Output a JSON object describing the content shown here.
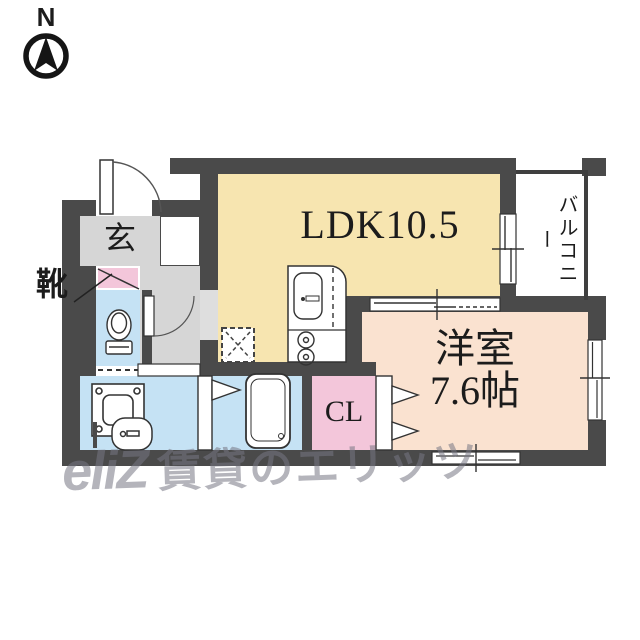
{
  "compass": {
    "north_label": "N"
  },
  "rooms": {
    "ldk": {
      "label": "LDK10.5"
    },
    "western_room": {
      "name": "洋室",
      "size": "7.6帖"
    },
    "closet": {
      "label": "CL"
    },
    "entrance": {
      "label": "玄"
    },
    "shoe_cabinet": {
      "label": "靴"
    },
    "balcony": {
      "label": "バルコニー"
    }
  },
  "watermark": {
    "logo": "eliZ",
    "text": "賃貸のエリッツ"
  },
  "colors": {
    "wall": "#4a4a4a",
    "ldk_floor": "#f7e5b0",
    "western_floor": "#fae2d0",
    "closet_floor": "#f3c6da",
    "wet_area_floor": "#c5e2f4",
    "hall_floor": "#d6d6d6",
    "shoebox_fill": "#f3c6da"
  },
  "fixtures": [
    "entrance-door",
    "shoe-box",
    "toilet",
    "washing-machine",
    "wash-basin",
    "bathtub",
    "kitchen-sink",
    "gas-stove",
    "refrigerator-space",
    "balcony-sliding-door",
    "room-sliding-door",
    "closet-folding-door",
    "window"
  ]
}
